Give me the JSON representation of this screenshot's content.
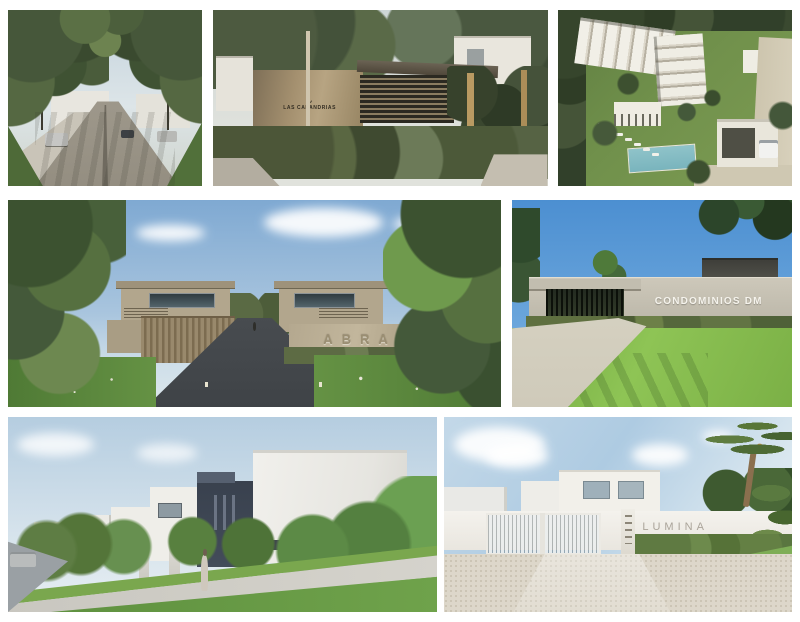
{
  "signage": {
    "las_calandrias": "LAS CALANDRIAS",
    "abra": "ABRA",
    "condominios_dm": "CONDOMINIOS DM",
    "lumina": "LUMINA"
  },
  "icons": {
    "bird_logo": "∿"
  },
  "colors": {
    "page_background": "#ffffff",
    "sky_blue_deep": "#4c8fd1",
    "sky_blue_soft": "#7fa9d2",
    "sky_pale": "#bcd2e2",
    "foliage_dark": "#3f5230",
    "foliage_light": "#6d8850",
    "lawn_green": "#70a73f",
    "concrete_warm": "#b2a68d",
    "concrete_grey": "#c2bcae",
    "stone_tan": "#a4906f",
    "asphalt_dark": "#4a4e52",
    "road_grey": "#9aa0a4",
    "gravel_light": "#ddd7ca",
    "render_white": "#f0efea",
    "navy_accent": "#3e4552",
    "pool_teal": "#86bfc6",
    "sign_white": "#f5f3ec",
    "sign_grey": "#aaa49a",
    "sign_emboss": "#9a8e72"
  }
}
